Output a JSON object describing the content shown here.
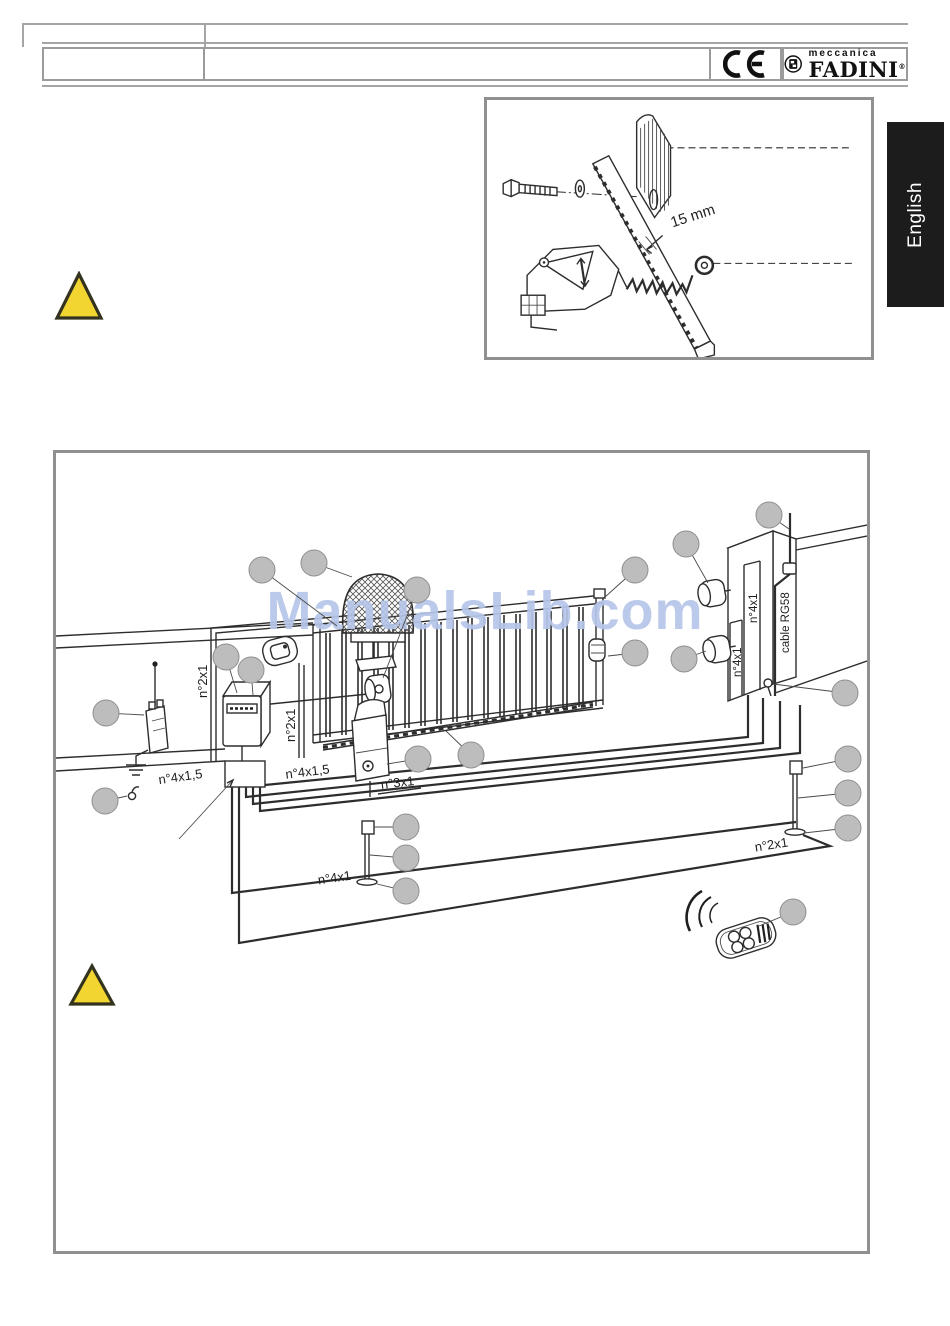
{
  "header": {
    "ce_label": "CE",
    "brand_top": "meccanica",
    "brand_name": "FADINI",
    "brand_reg": "®"
  },
  "language_tab": {
    "label": "English"
  },
  "inset_figure": {
    "dimension": "15 mm"
  },
  "diagram": {
    "watermark": "ManualsLib.com",
    "cable_labels": {
      "lamp_duct": "n°2x1",
      "selector_duct": "n°2x1",
      "left_mains": "n°4x1,5",
      "right_mains": "n°4x1,5",
      "motor_cable": "n°3x1",
      "pillar_duct_upper": "n°4x1",
      "pillar_duct_lower": "n°4x1",
      "antenna_cable": "cable RG58",
      "post_cable": "n°4x1",
      "ground_loop": "n°2x1"
    }
  },
  "colors": {
    "watermark": "#b6c6e9",
    "warning_fill": "#f2d531",
    "warning_stroke": "#33331f",
    "callout_fill": "#bdbdbd",
    "tab_bg": "#1c1c1c",
    "line_art": "#2d2d2d",
    "frame_border": "#909090"
  }
}
